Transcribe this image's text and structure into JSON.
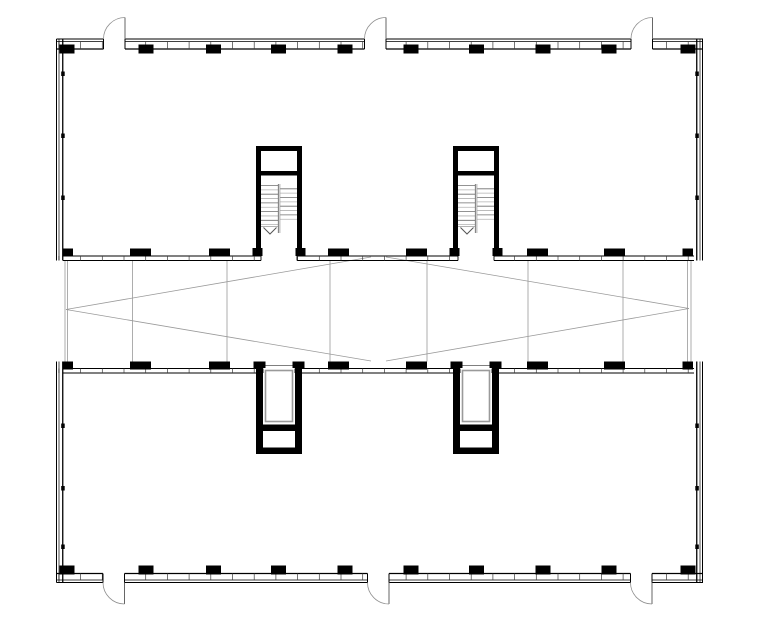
{
  "title": "architectural-floor-plan-two-wings-with-atrium-link",
  "canvas": {
    "width": 760,
    "height": 633,
    "background": "#ffffff"
  },
  "palette": {
    "wall": "#000000",
    "mullion": "#3a3a3a",
    "thin": "#8a8a8a",
    "brace": "#9a9a9a",
    "door": "#8f8f8f",
    "leaf": "#666666",
    "tread_dark": "#6f6f6f",
    "tread_light": "#b2b2b2",
    "divider_dark": "#555555",
    "divider_light": "#9a9a9a",
    "shaft": "#9a9a9a"
  },
  "bands": [
    {
      "id": "top-wing-north-wall",
      "o": "h",
      "span": [
        56.5,
        703
      ],
      "lines": [
        [
          39,
          1.1
        ],
        [
          41.5,
          0.8
        ],
        [
          49,
          1.2
        ]
      ],
      "tick": [
        41.5,
        49
      ],
      "t0": 58.9,
      "dt": 21.7,
      "gaps": [
        [
          103.5,
          125
        ],
        [
          364.5,
          386
        ],
        [
          631,
          652.5
        ]
      ]
    },
    {
      "id": "bottom-wing-south-wall",
      "o": "h",
      "span": [
        56.5,
        703
      ],
      "lines": [
        [
          582.5,
          1.1
        ],
        [
          580,
          0.8
        ],
        [
          573.5,
          1.2
        ]
      ],
      "tick": [
        573.5,
        580
      ],
      "t0": 58.9,
      "dt": 21.7,
      "gaps": [
        [
          103,
          124.5
        ],
        [
          367.5,
          389
        ],
        [
          630.5,
          652
        ]
      ]
    },
    {
      "id": "top-wing-south-wall",
      "o": "h",
      "span": [
        63,
        694
      ],
      "lines": [
        [
          256,
          0.9
        ],
        [
          260.5,
          1.0
        ]
      ],
      "tick": [
        256,
        260.5
      ],
      "t0": 58.9,
      "dt": 21.7,
      "gaps": [
        [
          261,
          297
        ],
        [
          458,
          494
        ]
      ]
    },
    {
      "id": "bottom-wing-north-wall",
      "o": "h",
      "span": [
        63,
        694
      ],
      "lines": [
        [
          368.5,
          0.9
        ],
        [
          373,
          1.0
        ]
      ],
      "tick": [
        368.5,
        373
      ],
      "t0": 58.9,
      "dt": 21.7,
      "gaps": [
        [
          263,
          295
        ],
        [
          460,
          492
        ]
      ]
    },
    {
      "id": "top-wing-west-wall",
      "o": "v",
      "span": [
        39,
        260.5
      ],
      "lines": [
        [
          56.5,
          1.0
        ],
        [
          59,
          0.7
        ],
        [
          62.75,
          1.3
        ]
      ],
      "tick": null,
      "gaps": []
    },
    {
      "id": "top-wing-east-wall",
      "o": "v",
      "span": [
        39,
        260.5
      ],
      "lines": [
        [
          702.5,
          1.0
        ],
        [
          700,
          0.7
        ],
        [
          696.75,
          1.3
        ]
      ],
      "tick": null,
      "gaps": []
    },
    {
      "id": "bottom-wing-west-wall",
      "o": "v",
      "span": [
        361.5,
        582.5
      ],
      "lines": [
        [
          56.5,
          1.0
        ],
        [
          59,
          0.7
        ],
        [
          62.75,
          1.3
        ]
      ],
      "tick": null,
      "gaps": []
    },
    {
      "id": "bottom-wing-east-wall",
      "o": "v",
      "span": [
        361.5,
        582.5
      ],
      "lines": [
        [
          702.5,
          1.0
        ],
        [
          700,
          0.7
        ],
        [
          696.75,
          1.3
        ]
      ],
      "tick": null,
      "gaps": []
    }
  ],
  "piers": {
    "outer": {
      "centers": [
        67,
        146,
        213.5,
        278.5,
        345,
        411,
        476.5,
        543,
        609,
        688
      ],
      "width": 15,
      "height": 9,
      "rows": [
        {
          "id": "top-wing-north-columns",
          "y": 44.5
        },
        {
          "id": "bottom-wing-south-columns",
          "y": 565.5
        }
      ]
    },
    "inner": {
      "ranges": [
        [
          62.5,
          73
        ],
        [
          130,
          151
        ],
        [
          209,
          230
        ],
        [
          328,
          349
        ],
        [
          406,
          427
        ],
        [
          527,
          548
        ],
        [
          604,
          625
        ],
        [
          682.5,
          693
        ]
      ],
      "height": 8,
      "rows": [
        {
          "id": "top-wing-south-piers",
          "y": 248.5
        },
        {
          "id": "bottom-wing-north-piers",
          "y": 361.5
        }
      ]
    },
    "side_ticks": {
      "size": [
        3.5,
        4.5
      ],
      "xs": [
        61.2,
        695.3
      ],
      "ys": [
        71.5,
        133.5,
        195.5,
        423.5,
        486,
        544.5
      ]
    }
  },
  "doors": [
    {
      "id": "door-top-left",
      "hinge": [
        125,
        39
      ],
      "width": 21.5,
      "swing": "up"
    },
    {
      "id": "door-top-center",
      "hinge": [
        386,
        39
      ],
      "width": 21.5,
      "swing": "up"
    },
    {
      "id": "door-top-right",
      "hinge": [
        652.5,
        39
      ],
      "width": 21.5,
      "swing": "up"
    },
    {
      "id": "door-bottom-left",
      "hinge": [
        124.5,
        582.5
      ],
      "width": 21.5,
      "swing": "down"
    },
    {
      "id": "door-bottom-center",
      "hinge": [
        389,
        582.5
      ],
      "width": 21.5,
      "swing": "down"
    },
    {
      "id": "door-bottom-right",
      "hinge": [
        652,
        582.5
      ],
      "width": 21.5,
      "swing": "down"
    }
  ],
  "stair_cores": [
    {
      "id": "stair-core-west",
      "x": 256
    },
    {
      "id": "stair-core-east",
      "x": 453
    }
  ],
  "stair_core_spec": {
    "y": 146,
    "width": 46,
    "wall": 5,
    "height": 110,
    "vestibule_divider_y": 171,
    "divider_h": 4.5,
    "left_treads": {
      "y0": 185.5,
      "count": 10,
      "dy": 4.35
    },
    "right_treads": {
      "y0": 188.8,
      "count": 8,
      "dy": 4.35
    },
    "flight_divider": [
      184,
      233
    ],
    "landing_y": 226.5,
    "arrow": {
      "x1": 7.5,
      "xm": 14,
      "x2": 20.5,
      "y1": 227.5,
      "y2": 234
    },
    "stub_y": 248,
    "stub_h": 8,
    "stub_w": 10
  },
  "elevator_cores": [
    {
      "id": "elevator-core-west",
      "x": 256
    },
    {
      "id": "elevator-core-east",
      "x": 453
    }
  ],
  "elevator_core_spec": {
    "y": 361.5,
    "width": 46,
    "wall": 7,
    "bottom_y": 454,
    "divider_y": 424.5,
    "divider_h": 6.5,
    "bottom_wall_h": 6.5,
    "stub_h": 6.5,
    "stub_w": 12,
    "opening_line_y": 365.5,
    "shaft": {
      "inset": 9.5,
      "y": 370.5,
      "h": 51
    }
  },
  "atrium": {
    "verticals": {
      "x": [
        65,
        67.5,
        132.5,
        227,
        330,
        427,
        528,
        623,
        687.5,
        691
      ],
      "y1": 260.5,
      "y2": 361.5
    },
    "braces": [
      [
        [
          66,
          309.5
        ],
        [
          371,
          257
        ]
      ],
      [
        [
          386,
          257
        ],
        [
          689,
          308.5
        ]
      ],
      [
        [
          66,
          309.5
        ],
        [
          371,
          361
        ]
      ],
      [
        [
          386,
          361
        ],
        [
          689,
          308.5
        ]
      ]
    ]
  }
}
